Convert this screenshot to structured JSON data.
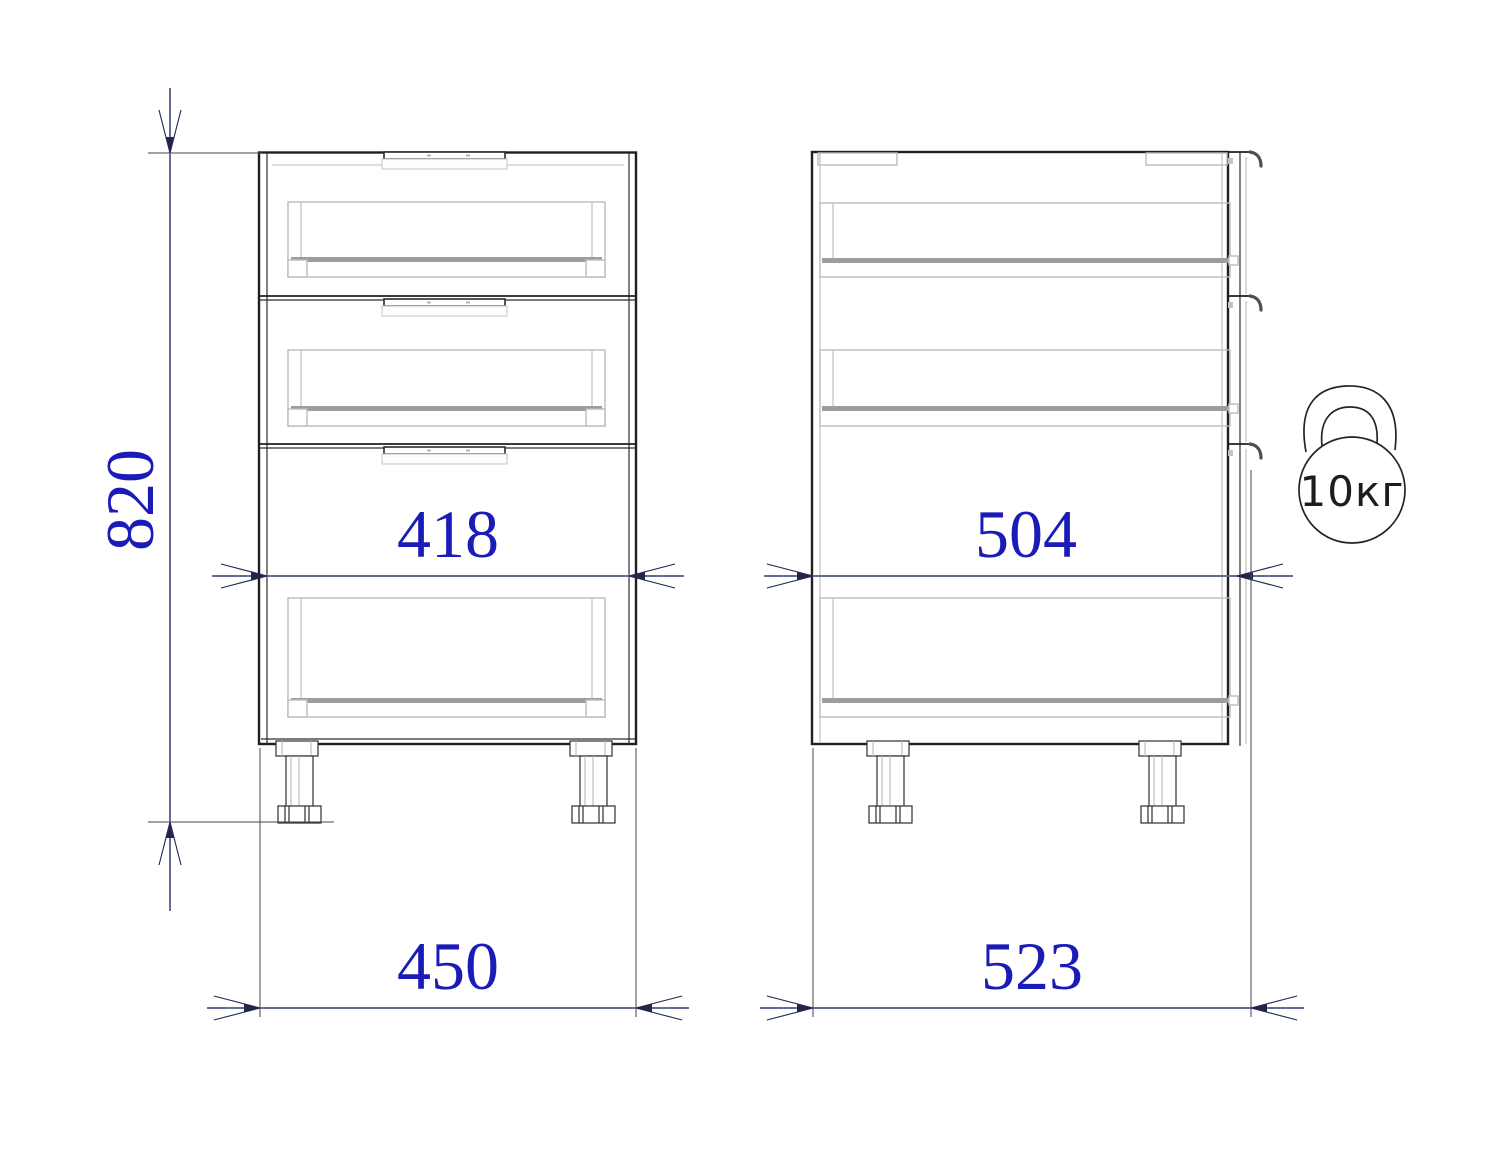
{
  "dimensions": {
    "height": "820",
    "inner_width": "418",
    "overall_width": "450",
    "inner_depth": "504",
    "overall_depth": "523"
  },
  "weight_badge": {
    "label": "10кг"
  },
  "colors": {
    "dim-text": "#1b1bb8",
    "dim-line": "#666d92",
    "arrow": "#22254d",
    "outline": "#1f1f1f",
    "internal": "#bcbcbc",
    "rail": "#9d9d9d"
  }
}
